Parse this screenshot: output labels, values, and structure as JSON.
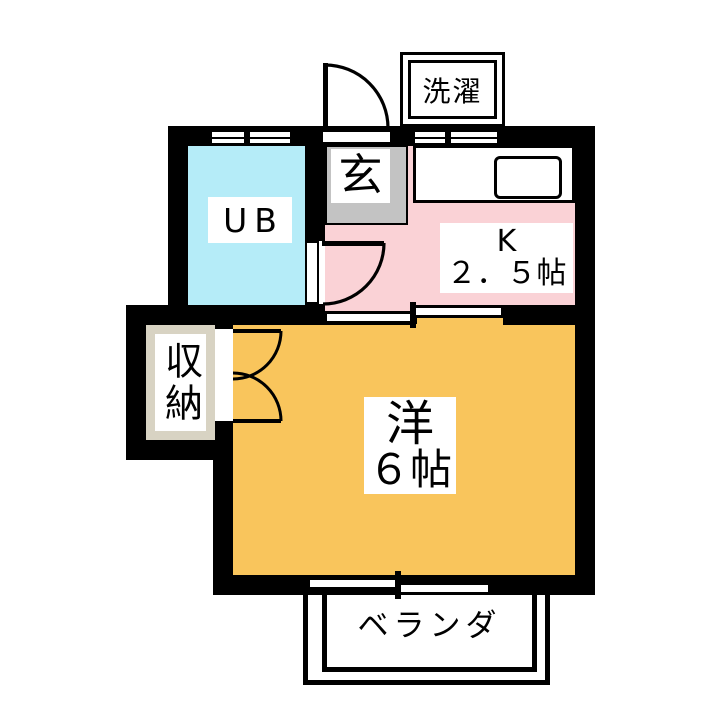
{
  "plan_type": "apartment-floor-plan",
  "labels": {
    "laundry": "洗濯",
    "entrance": "玄",
    "unit_bath": "UB",
    "kitchen_name": "K",
    "kitchen_size": "２．５帖",
    "closet": "収納",
    "western_room_name": "洋",
    "western_room_size": "６帖",
    "veranda": "ベランダ"
  },
  "colors": {
    "wall": "#000000",
    "unit_bath_floor": "#b5ecf8",
    "kitchen_floor": "#fad2d6",
    "entrance_floor": "#c3c3c3",
    "western_room_floor": "#f9c55c",
    "closet_frame": "#d8d3c3",
    "background": "#ffffff"
  }
}
